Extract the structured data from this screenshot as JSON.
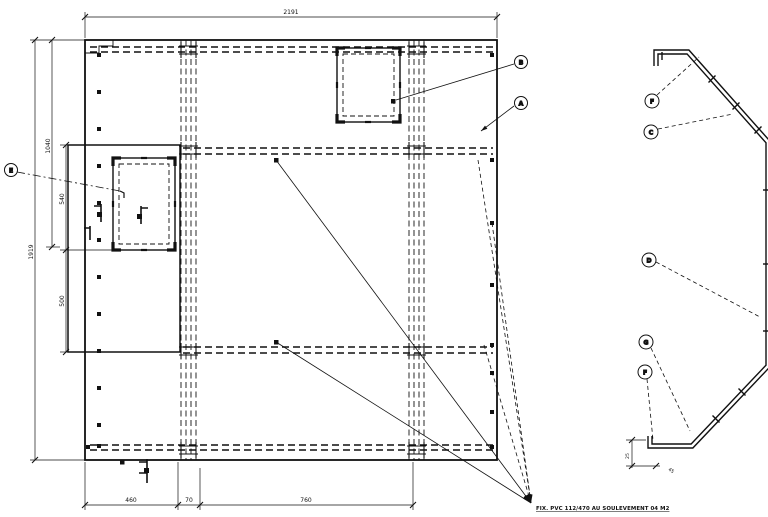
{
  "drawing": {
    "type": "cad-panel-drawing",
    "ink_color": "#111111",
    "background_color": "#ffffff",
    "plan_view": {
      "dims": {
        "top_width": "2191",
        "left_height_outer": "1919",
        "left_height_inner": "1040",
        "subpanel_upper": "540",
        "subpanel_lower": "500",
        "bottom_left": "460",
        "bottom_seam": "70",
        "bottom_mid": "760"
      },
      "callouts": {
        "e": "E",
        "b": "B",
        "a": "A"
      }
    },
    "section_view": {
      "callouts": {
        "f_top": "F",
        "c": "C",
        "d": "D",
        "g": "G",
        "f_bottom": "F"
      },
      "dims": {
        "hook_height": "25",
        "hook_offset": "45"
      }
    },
    "note": {
      "text": "FIX. PVC 112/470 AU SOULEVEMENT 04 M2"
    }
  }
}
